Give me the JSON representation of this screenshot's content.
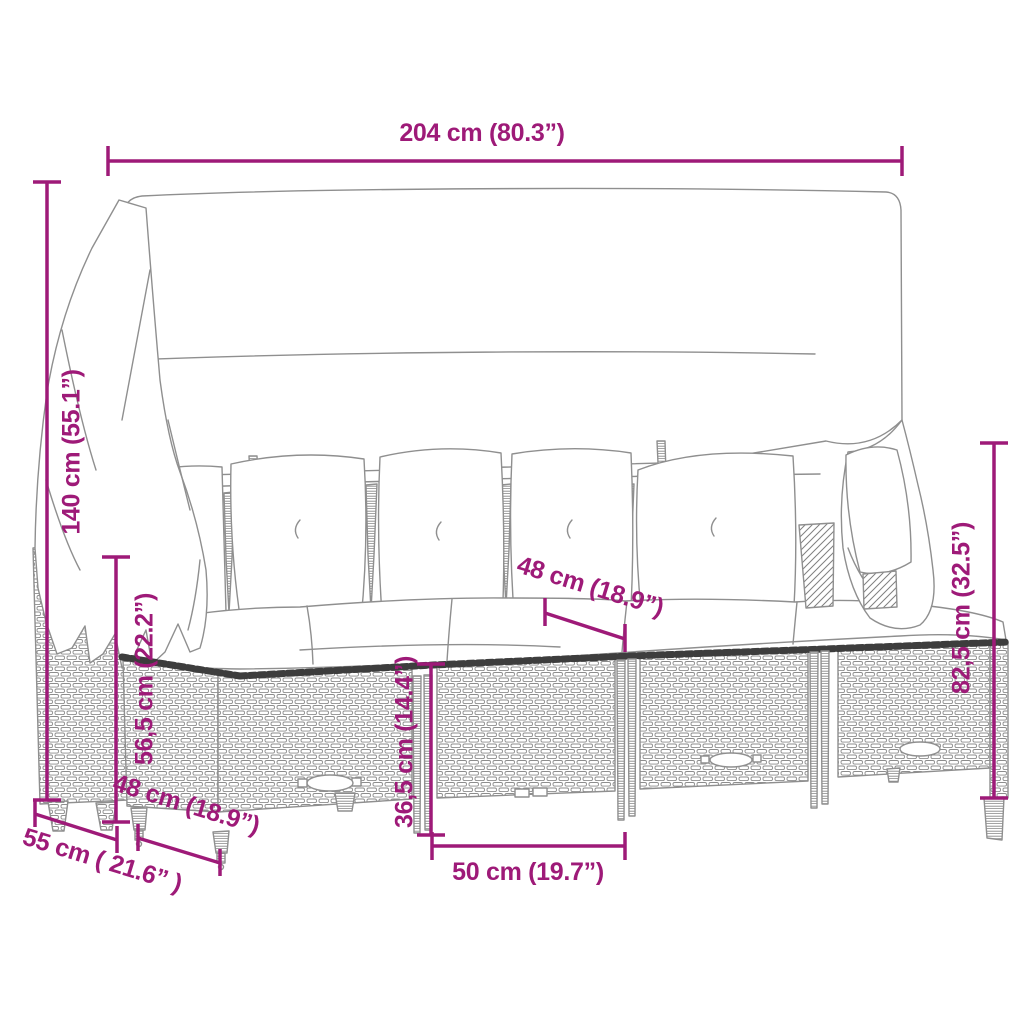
{
  "diagram": {
    "type": "product-dimension-diagram",
    "product": "garden-lounge-set-with-canopy",
    "background": "#ffffff",
    "accent_color": "#9E1A78",
    "sketch_color": "#8f8f8f",
    "braid_color": "#3d3d3d",
    "dimensions": [
      {
        "id": "overall-width",
        "label": "204 cm (80.3”)",
        "orientation": "horizontal",
        "position": "top"
      },
      {
        "id": "overall-height",
        "label": "140 cm (55.1”)",
        "orientation": "vertical",
        "position": "left-outer"
      },
      {
        "id": "armrest-height",
        "label": "56,5 cm (22.2”)",
        "orientation": "vertical",
        "position": "left-inner"
      },
      {
        "id": "back-height",
        "label": "82,5 cm (32.5”)",
        "orientation": "vertical",
        "position": "right"
      },
      {
        "id": "seat-width-mid",
        "label": "48 cm (18.9”)",
        "orientation": "diagonal",
        "position": "middle"
      },
      {
        "id": "base-height",
        "label": "36,5 cm (14.4”)",
        "orientation": "vertical",
        "position": "middle-bottom"
      },
      {
        "id": "seat-front-width",
        "label": "50 cm (19.7”)",
        "orientation": "horizontal",
        "position": "bottom"
      },
      {
        "id": "seat-depth",
        "label": "48 cm (18.9”)",
        "orientation": "diagonal",
        "position": "bottom-left"
      },
      {
        "id": "overall-depth",
        "label": "55 cm ( 21.6” )",
        "orientation": "diagonal",
        "position": "bottom-left-outer"
      }
    ]
  }
}
